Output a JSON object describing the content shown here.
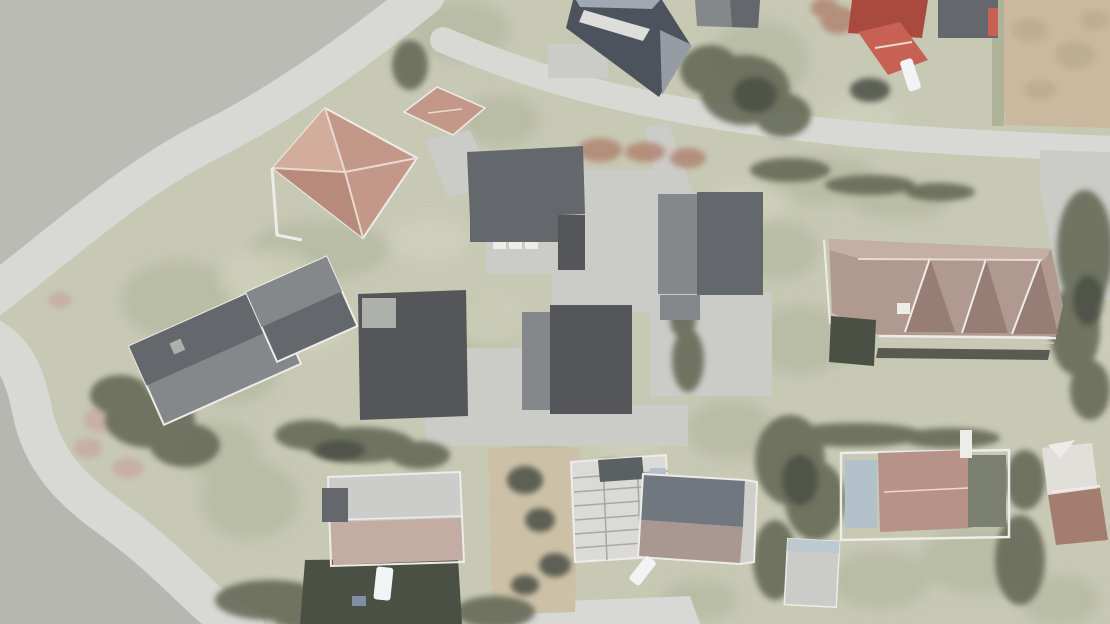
{
  "scene": {
    "description": "Washed-out aerial drone orthophoto of a residential neighborhood with curving roads, hip-roof and flat-roof houses, lawns, hedges, driveways and parked cars. No UI chrome or text is visible.",
    "style": "hazy, low-contrast, white-washed overhead photograph",
    "cars_visible": 3,
    "palette": {
      "baseGreen": "#c3c5af",
      "paleGreen": "#d0d2bc",
      "midGreen": "#a9ae93",
      "darkGreen": "#7d8268",
      "treeDark": "#5b614b",
      "nearBlack": "#3e4337",
      "plainGray": "#b6b6b1",
      "plainGray2": "#b2b2ad",
      "roadGray": "#d5d5d1",
      "paveGray": "#c8c8c3",
      "darkRoof": "#595d61",
      "darkerRoof": "#474a4e",
      "midRoof": "#7b7f82",
      "steel": "#8f959c",
      "lightNotch": "#a8aba6",
      "blueRoofDark": "#3f4650",
      "blueRoofLight": "#99a2ae",
      "redRoofFace": "#c09181",
      "redRoofLight": "#cfa795",
      "redRoofDark": "#b28273",
      "ridgeWhite": "#e8d8cd",
      "brownRoof": "#ab9387",
      "brownRoofLight": "#bfa99d",
      "dormer": "#8f756a",
      "wallShadow": "#4b4f44",
      "eaveLine": "#cfc3ba",
      "tanField": "#c6b497",
      "tanMottle": "#b2a082",
      "tanGarden": "#c9bda1",
      "rosy": "#c3a49a",
      "rust": "#a8735f",
      "white": "#ecebe7",
      "carWhite": "#f2f3f4",
      "redHouse": "#c25647",
      "redHouseDark": "#a23d30",
      "slateRoof": "#666d75",
      "slateLower": "#a39089",
      "gableLight": "#cccbc7",
      "lightRoofH": "#c9c9c6",
      "lowerPink": "#bfa69a",
      "constrWhite": "#d9d8d3",
      "constrLine": "#9da3a7",
      "constrDark": "#4f5457",
      "shedGray": "#c8c7c3",
      "shedBlue": "#b8c5ce",
      "pinkRoof": "#b28a80",
      "blueSection": "#aebdc8",
      "oliveRoof": "#717767",
      "whiteRoofM": "#dfddd8",
      "brownRoofM": "#9d7466",
      "blueSpeck": "#7787a0",
      "veil": "rgba(255,255,255,0.07)"
    },
    "features": [
      {
        "label": "flat gray terrain, upper left"
      },
      {
        "label": "main curving road"
      },
      {
        "label": "side road descending along left edge"
      },
      {
        "label": "upper road running to the right edge"
      },
      {
        "label": "red hip-roof villa, upper left"
      },
      {
        "label": "dark flat-roof building complex with paved courtyard, center"
      },
      {
        "label": "large brown hip-roof house with three dormers, right"
      },
      {
        "label": "two gray gable-roof houses, middle left"
      },
      {
        "label": "houses, gardens and parked cars along the bottom"
      },
      {
        "label": "tan stubble field, top right corner"
      }
    ]
  }
}
